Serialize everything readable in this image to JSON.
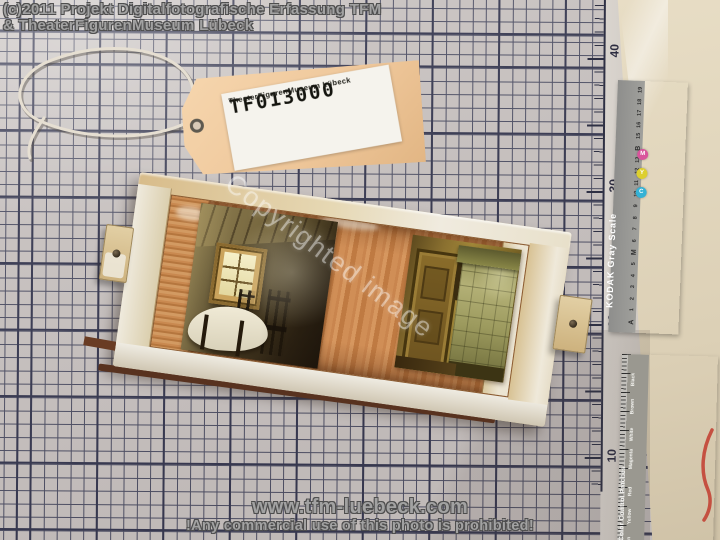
{
  "overlay": {
    "copyright_line1": "(c)2011 Projekt Digitalfotografische Erfassung TFM",
    "copyright_line2": "& TheaterFigurenMuseum Lübeck",
    "diagonal_watermark": "Copyrighted image",
    "website": "www.tfm-luebeck.com",
    "notice": "!Any commercial use of this photo is prohibited!"
  },
  "tag": {
    "id": "TF013000",
    "museum": "TheaterFigurenMuseum Lübeck"
  },
  "mat": {
    "ruler_numbers": [
      "40",
      "30",
      "20",
      "10"
    ]
  },
  "kodak_gray_scale": {
    "title": "KODAK Gray Scale",
    "cmy_dots": [
      {
        "letter": "M",
        "color": "#d9559c"
      },
      {
        "letter": "Y",
        "color": "#ddcf2e"
      },
      {
        "letter": "C",
        "color": "#35b2d5"
      }
    ],
    "scale_labels_bottom_to_top": [
      "A",
      "1",
      "2",
      "3",
      "4",
      "5",
      "M",
      "6",
      "7",
      "8",
      "9",
      "10",
      "11",
      "12",
      "13",
      "B",
      "15",
      "16",
      "17",
      "18",
      "19"
    ]
  },
  "color_control": {
    "title": "Color Control Patches",
    "patches": [
      {
        "label": "Black",
        "tint": "#ece9e3",
        "color": "#211d18"
      },
      {
        "label": "Brown",
        "tint": "#dcd8d0",
        "color": "#5e2620"
      },
      {
        "label": "White",
        "tint": "#f2efe9",
        "color": "#f4f1ea"
      },
      {
        "label": "Magenta",
        "tint": "#e9d9e6",
        "color": "#a87cb4"
      },
      {
        "label": "Red",
        "tint": "#f2d8da",
        "color": "#d84034"
      },
      {
        "label": "Yellow",
        "tint": "#f0edcf",
        "color": "#d6cb32"
      },
      {
        "label": "Green",
        "tint": "#e2ead9",
        "color": "#4f9d55"
      }
    ]
  },
  "colors": {
    "mat-surface": "#c9c3c1",
    "grid-line": "#4a4c62",
    "grid-line-bold": "#33354e",
    "tag-color": "#eec699",
    "table-surface": "#e4d9c0",
    "box-wood": "#c9854e"
  }
}
